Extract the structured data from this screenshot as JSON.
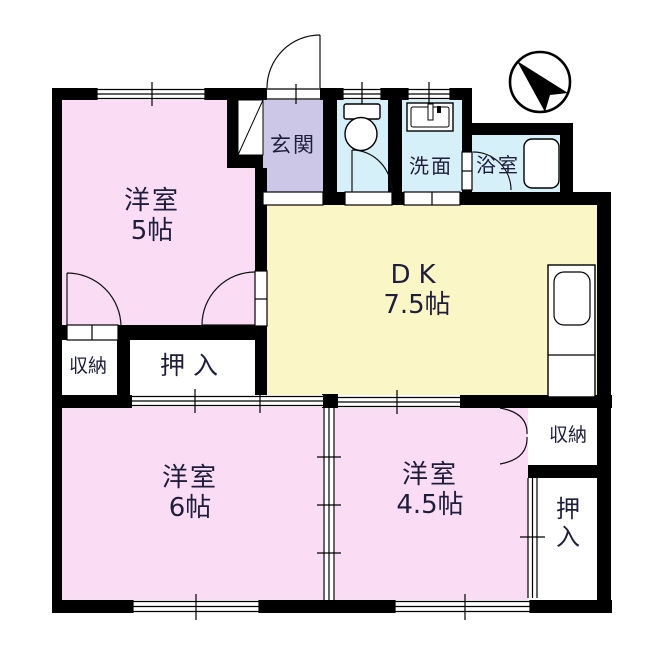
{
  "title": "2DK floor plan",
  "colors": {
    "pink": "#fadcf5",
    "yellow": "#faf6c6",
    "blue": "#d6f0fa",
    "lavender": "#ccc7e6",
    "wall": "#000000",
    "text": "#1e1e3c",
    "line": "#111111"
  },
  "rooms": {
    "west5": {
      "label": "洋室",
      "size": "5帖"
    },
    "entrance": {
      "label": "玄関"
    },
    "washroom": {
      "label": "洗面"
    },
    "bathroom": {
      "label": "浴室"
    },
    "dk": {
      "label": "DK",
      "size": "7.5帖"
    },
    "closet_left": {
      "label": "押入"
    },
    "storage_left": {
      "label": "収納"
    },
    "west6": {
      "label": "洋室",
      "size": "6帖"
    },
    "west45": {
      "label": "洋室",
      "size": "4.5帖"
    },
    "storage_right": {
      "label": "収納"
    },
    "closet_right": {
      "label": "押入",
      "chars": [
        "押",
        "入"
      ]
    }
  },
  "compass": {
    "name": "north-arrow"
  }
}
